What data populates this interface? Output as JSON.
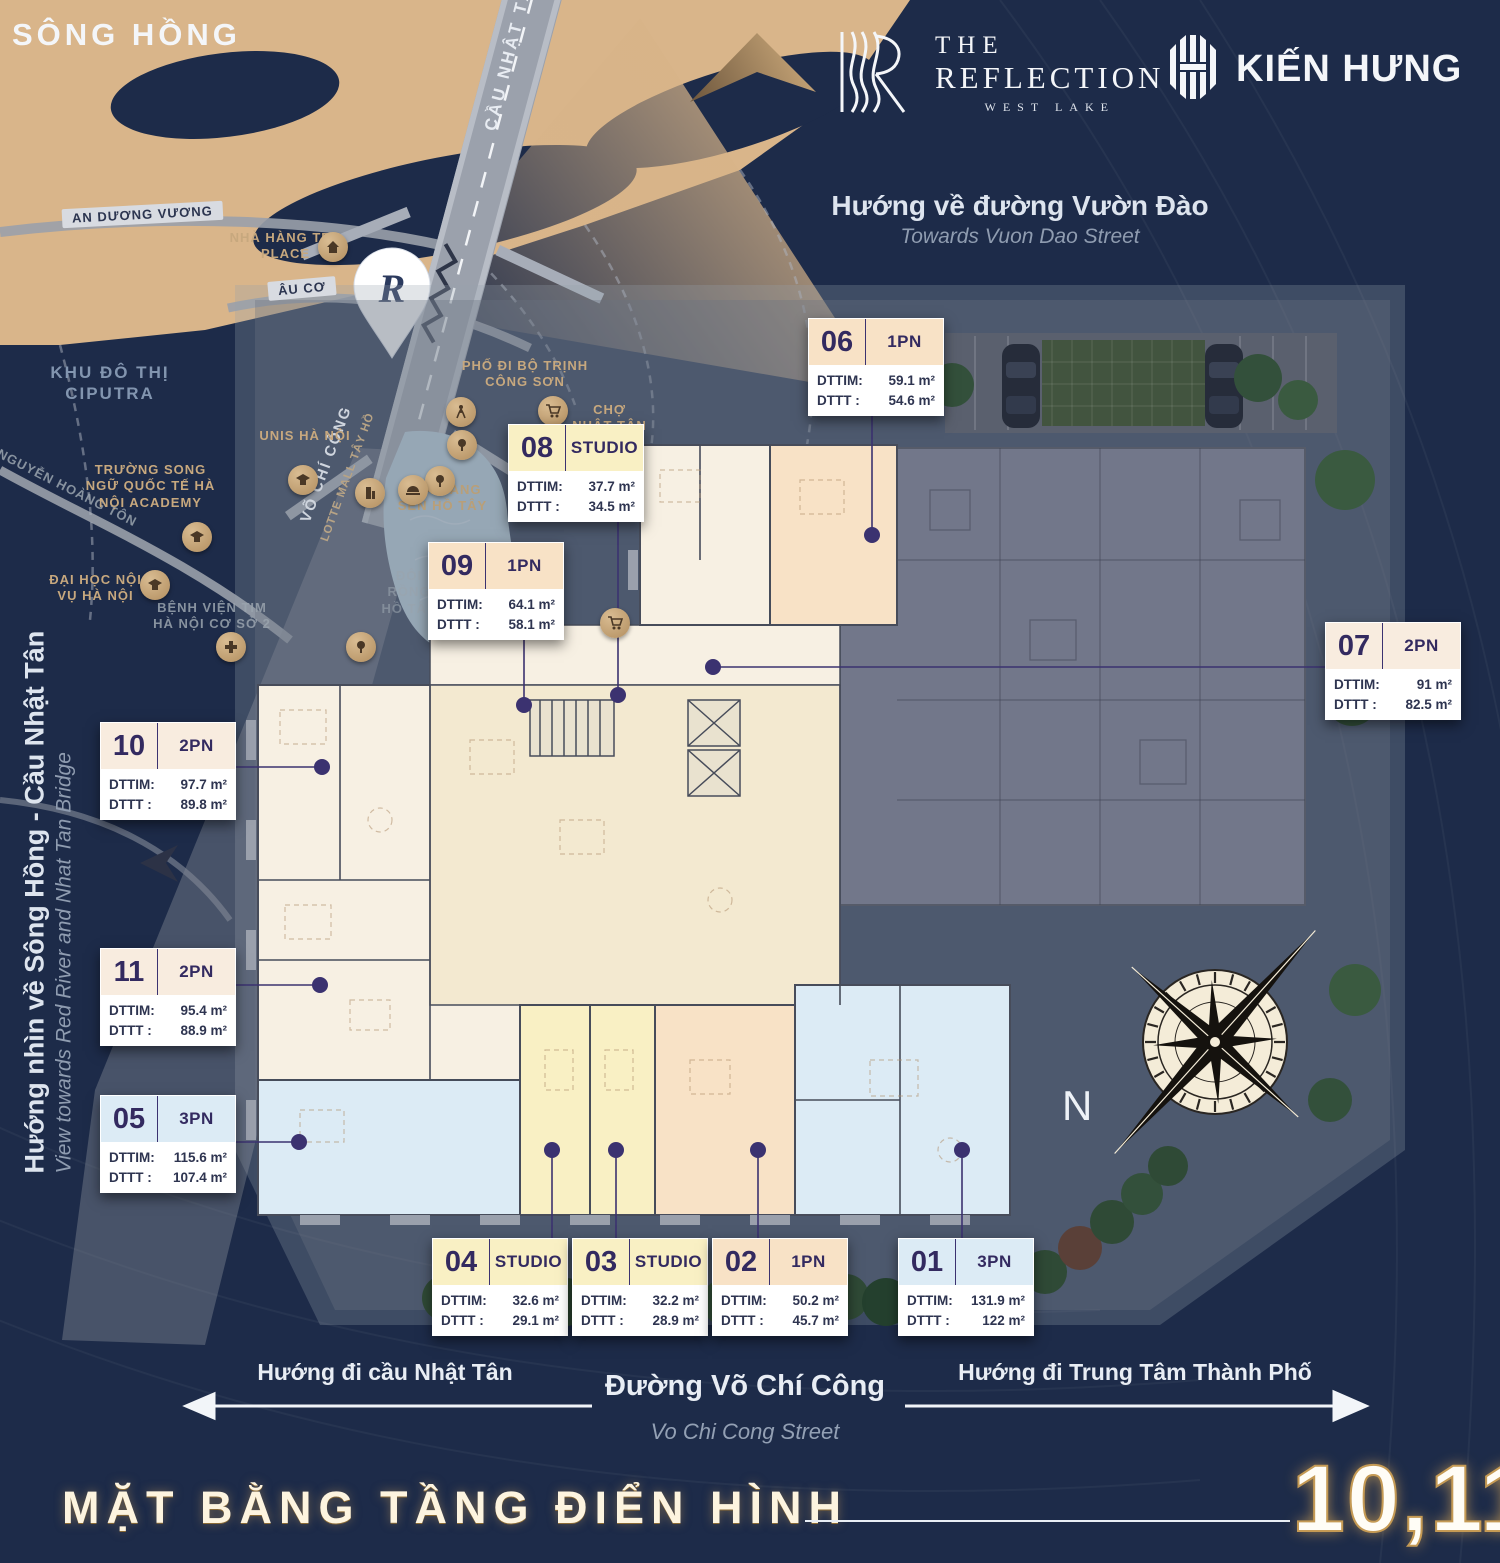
{
  "header": {
    "reflection_logo": {
      "the": "THE",
      "name": "REFLECTION",
      "sub": "WEST LAKE"
    },
    "kienhung_logo": "KIẾN HƯNG"
  },
  "top_direction": {
    "vi": "Hướng về đường Vườn Đào",
    "en": "Towards Vuon Dao Street"
  },
  "left_direction": {
    "vi": "Hướng nhìn về Sông Hồng - Cầu Nhật Tân",
    "en": "View towards Red River and Nhat Tan Bridge"
  },
  "map": {
    "river": "SÔNG HỒNG",
    "bridge": "CẦU NHẬT TÂN",
    "roads": {
      "an_duong_vuong": "AN DƯƠNG VƯƠNG",
      "au_co": "ÂU CƠ",
      "vo_chi_cong": "VÕ CHÍ CÔNG",
      "nguyen_hoang_ton": "NGUYỄN HOÀNG TÔN",
      "lotte_mall": "LOTTE MALL TÂY HỒ"
    },
    "pois": {
      "ciputra": "KHU ĐÔ THỊ CIPUTRA",
      "tre_place": "NHÀ HÀNG TRE PLACE",
      "unis": "UNIS HÀ NỘI",
      "song_ngu": "TRƯỜNG SONG NGỮ QUỐC TẾ HÀ NỘI ACADEMY",
      "dai_hoc": "ĐẠI HỌC NỘI VỤ HÀ NỘI",
      "benh_vien": "BỆNH VIỆN TIM HÀ NỘI CƠ SỞ 2",
      "pho_di_bo": "PHỐ ĐI BỘ TRỊNH CÔNG SƠN",
      "cho_nhat_tan": "CHỢ NHẬT TÂN",
      "sen_ho_tay": "NHÀ HÀNG SEN HỒ TÂY",
      "doi_rong": "ĐÔI RỒNG HỒ TÂY"
    }
  },
  "bottom_directions": {
    "left": "Hướng đi cầu Nhật Tân",
    "street_vi": "Đường Võ Chí Công",
    "street_en": "Vo Chi Cong Street",
    "right": "Hướng đi Trung Tâm Thành Phố"
  },
  "compass": {
    "label": "N"
  },
  "footer": {
    "title": "MẶT BẰNG TẦNG ĐIỂN HÌNH",
    "floors": "10,11"
  },
  "area_labels": {
    "dttim": "DTTIM:",
    "dttt": "DTTT :"
  },
  "units": [
    {
      "no": "06",
      "type": "1PN",
      "dttim": "59.1 m²",
      "dttt": "54.6 m²",
      "color_key": "one_pn"
    },
    {
      "no": "08",
      "type": "STUDIO",
      "dttim": "37.7 m²",
      "dttt": "34.5 m²",
      "color_key": "studio"
    },
    {
      "no": "09",
      "type": "1PN",
      "dttim": "64.1 m²",
      "dttt": "58.1 m²",
      "color_key": "one_pn"
    },
    {
      "no": "07",
      "type": "2PN",
      "dttim": "91 m²",
      "dttt": "82.5 m²",
      "color_key": "two_pn"
    },
    {
      "no": "10",
      "type": "2PN",
      "dttim": "97.7 m²",
      "dttt": "89.8 m²",
      "color_key": "two_pn"
    },
    {
      "no": "11",
      "type": "2PN",
      "dttim": "95.4 m²",
      "dttt": "88.9 m²",
      "color_key": "two_pn"
    },
    {
      "no": "05",
      "type": "3PN",
      "dttim": "115.6 m²",
      "dttt": "107.4 m²",
      "color_key": "three_pn"
    },
    {
      "no": "04",
      "type": "STUDIO",
      "dttim": "32.6 m²",
      "dttt": "29.1 m²",
      "color_key": "studio"
    },
    {
      "no": "03",
      "type": "STUDIO",
      "dttim": "32.2 m²",
      "dttt": "28.9 m²",
      "color_key": "studio"
    },
    {
      "no": "02",
      "type": "1PN",
      "dttim": "50.2 m²",
      "dttt": "45.7 m²",
      "color_key": "one_pn"
    },
    {
      "no": "01",
      "type": "3PN",
      "dttim": "131.9 m²",
      "dttt": "122 m²",
      "color_key": "three_pn"
    }
  ],
  "colors": {
    "studio": "#f9f0c4",
    "one_pn": "#f8e2c6",
    "two_pn": "#f8ecdf",
    "three_pn": "#dcebf5",
    "plan_cream": "#f7f0e3",
    "plan_core": "#f3e9d0",
    "plan_gray_wing": "#72778a",
    "leader": "#3b3270",
    "sand": "#d9b58a",
    "lake": "#b7d0e1",
    "navy_bg": "#1d2b49"
  }
}
